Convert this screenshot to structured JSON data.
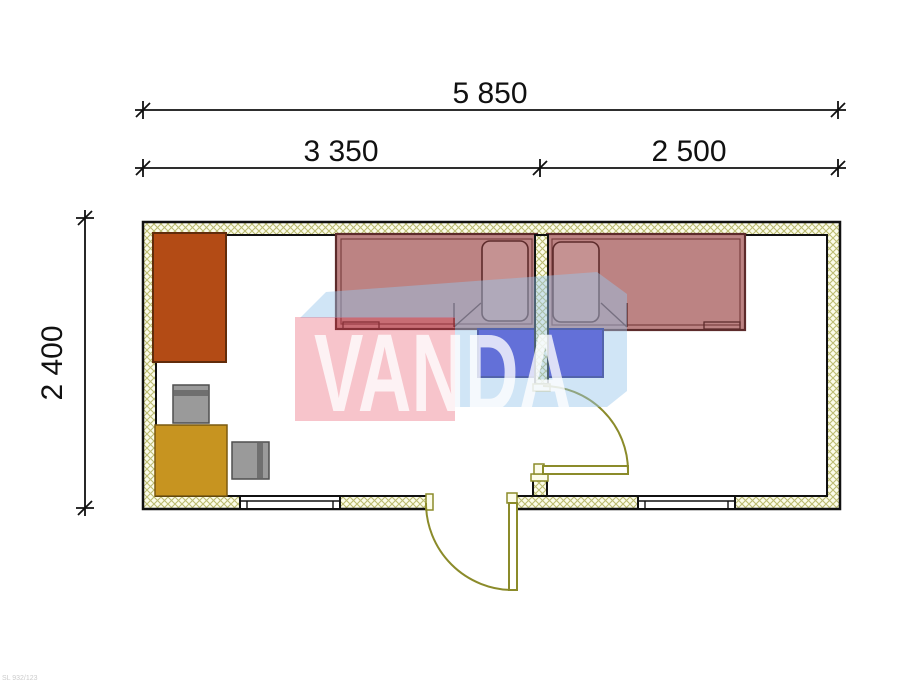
{
  "drawing": {
    "type": "floor-plan",
    "code_label": "SL 932/123"
  },
  "dimensions": {
    "overall_width": "5 850",
    "left_room_width": "3 350",
    "right_room_width": "2 500",
    "depth": "2 400"
  },
  "watermark": {
    "text": "VANDA"
  },
  "rooms": [
    {
      "name": "left-room",
      "width_label": "3 350"
    },
    {
      "name": "right-room",
      "width_label": "2 500"
    }
  ],
  "colors": {
    "line": "#111111",
    "wall_bg": "#fcfcea",
    "hatch_line": "#bcbc72",
    "floor": "#ffffff",
    "door": "#8b8b2a",
    "door_fill": "#ffffff",
    "jamb_fill": "#fcfcea",
    "bed": "#bc8383",
    "bed_outline": "#5d2b2b",
    "bed_inner": "#7a4040",
    "pillow": "#c59292",
    "nightstand": "#3a2bc9",
    "nightstand_outline": "#1c1478",
    "wardrobe": "#b34b15",
    "wardrobe_outline": "#612c0b",
    "cabinet": "#c79420",
    "cabinet_outline": "#7a5a10",
    "chair": "#9a9a9a",
    "chair_band": "#6f6f6f",
    "chair_outline": "#4f4f4f",
    "wm_pink": "rgba(228,60,82,0.30)",
    "wm_blue": "rgba(150,198,235,0.45)",
    "wm_letters": "rgba(255,255,255,0.78)"
  }
}
